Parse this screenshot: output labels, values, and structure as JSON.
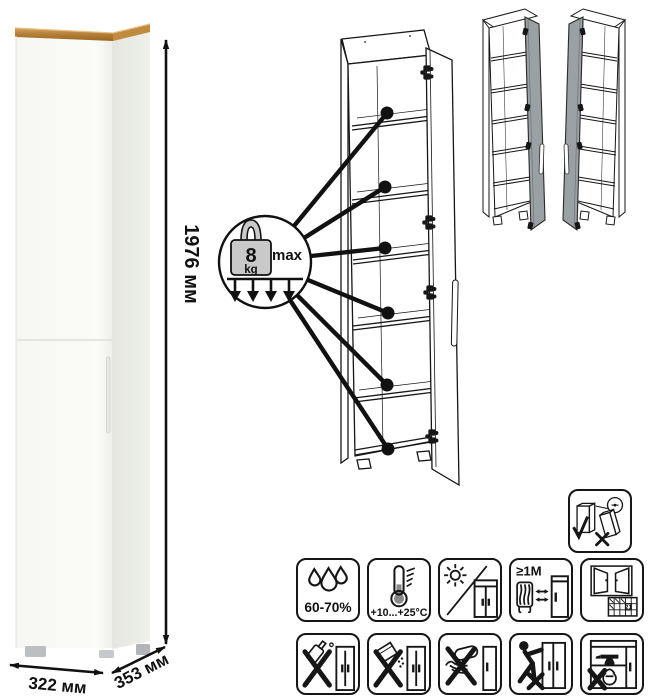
{
  "product": {
    "height": "1976 мм",
    "width": "322 мм",
    "depth": "353 мм"
  },
  "shelf_load": {
    "value": "8",
    "unit": "kg",
    "qualifier": "max",
    "shelf_count": 6
  },
  "door_variants": [
    "door-hinged-right",
    "door-hinged-left"
  ],
  "care": {
    "humidity": "60-70%",
    "temperature": "+10...+25°C",
    "min_heat_distance": "≥1M",
    "ventilation_day": "21"
  },
  "palette": {
    "wood_top": "#b5803c",
    "door_gray": "#99a0a3",
    "door_gray_dark": "#8b9295",
    "weight_gray": "#c9c9c9",
    "line_black": "#161616"
  }
}
